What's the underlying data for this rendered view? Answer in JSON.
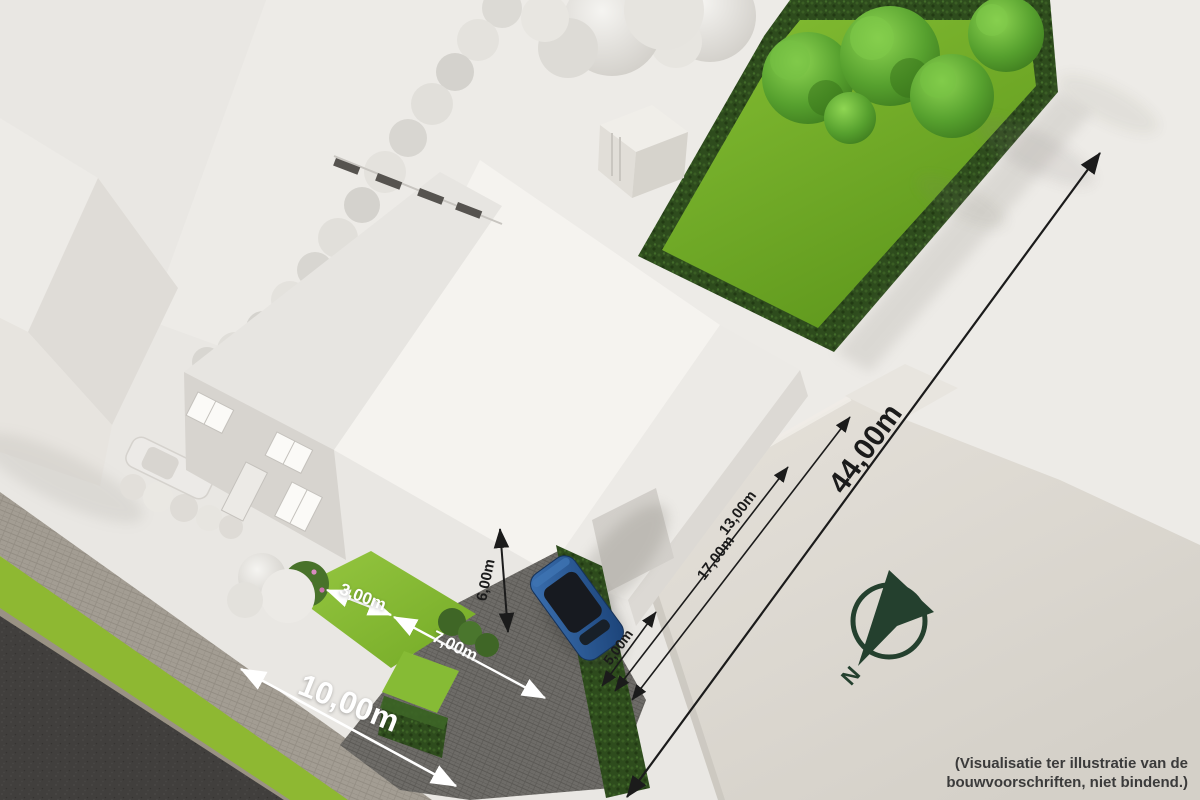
{
  "scene_description": "3D aerial visualisation of a building plot with house, gardens, driveway and dimension annotations",
  "annotations": {
    "dimensions": [
      {
        "id": "plot-front-width",
        "label": "10,00m"
      },
      {
        "id": "front-garden-width",
        "label": "3,00m"
      },
      {
        "id": "driveway-width",
        "label": "7,00m"
      },
      {
        "id": "building-height",
        "label": "6,00m"
      },
      {
        "id": "side-strip-width",
        "label": "5,00m"
      },
      {
        "id": "building-depth",
        "label": "13,00m"
      },
      {
        "id": "buildable-depth",
        "label": "17,00m"
      },
      {
        "id": "plot-depth",
        "label": "44,00m"
      }
    ],
    "compass_label": "N",
    "disclaimer": [
      "(Visualisatie ter illustratie van de",
      "bouwvoorschriften, niet bindend.)"
    ]
  },
  "colors": {
    "ground": "#e9e7e3",
    "road": "#413f3d",
    "sidewalk_pavers": "#a39d93",
    "grass_verge": "#8eb832",
    "lawn": "#7fb62e",
    "hedge": "#2e4c1d",
    "tree_green": "#57a233",
    "white_vegetation": "#e2e0db",
    "house_wall": "#d7d4cf",
    "house_roof_bright": "#f4f2ee",
    "neighbor_building": "#dcd8d1",
    "driveway_pavers": "#6e6c68",
    "car_blue": "#27588f",
    "dimension_dark_text": "#1b1b1b",
    "dimension_light_text": "#ffffff",
    "compass_green": "#24402e",
    "disclaimer_text": "#3b3b3b"
  }
}
